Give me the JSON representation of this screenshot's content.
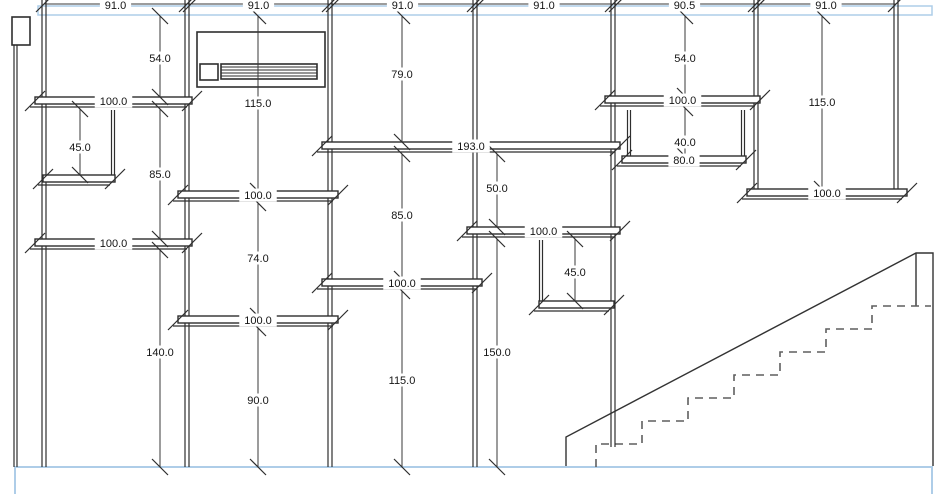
{
  "drawing": {
    "canvas": {
      "width": 950,
      "height": 494,
      "background": "#ffffff"
    },
    "colors": {
      "line": "#2e2e2e",
      "dimension": "#3a3a3a",
      "plate_highlight": "#aecde8",
      "stair_dash": "#5f5f5f",
      "text": "#141414"
    },
    "plates": {
      "top_band": {
        "x": 38,
        "y": 6,
        "w": 894,
        "h": 9
      },
      "bottom_band": {
        "x1": 15,
        "x2": 932,
        "y": 467,
        "bottom": 494
      }
    },
    "corner_box": {
      "x": 12,
      "y": 17,
      "w": 18,
      "h": 28
    },
    "top_dimension_line": {
      "y": 4,
      "x_start": 44,
      "x_end": 896,
      "ticks": [
        44,
        187,
        330,
        475,
        613,
        756,
        896
      ],
      "segments": [
        {
          "x1": 44,
          "x2": 187,
          "label": "91.0"
        },
        {
          "x1": 187,
          "x2": 330,
          "label": "91.0"
        },
        {
          "x1": 330,
          "x2": 475,
          "label": "91.0"
        },
        {
          "x1": 475,
          "x2": 613,
          "label": "91.0"
        },
        {
          "x1": 613,
          "x2": 756,
          "label": "90.5"
        },
        {
          "x1": 756,
          "x2": 896,
          "label": "91.0"
        }
      ]
    },
    "studs": [
      {
        "x": 15.5,
        "y1": 45,
        "y2": 467,
        "gap": 3
      },
      {
        "x": 44,
        "y1": 0,
        "y2": 467,
        "gap": 4
      },
      {
        "x": 187,
        "y1": 0,
        "y2": 467,
        "gap": 4
      },
      {
        "x": 330,
        "y1": 0,
        "y2": 467,
        "gap": 4
      },
      {
        "x": 475,
        "y1": 0,
        "y2": 467,
        "gap": 4
      },
      {
        "x": 613,
        "y1": 0,
        "y2": 447,
        "gap": 4
      },
      {
        "x": 756,
        "y1": 0,
        "y2": 192,
        "gap": 4
      },
      {
        "x": 896,
        "y1": 0,
        "y2": 190,
        "gap": 4
      },
      {
        "x": 113,
        "y1": 110,
        "y2": 176,
        "gap": 3
      },
      {
        "x": 541,
        "y1": 240,
        "y2": 302,
        "gap": 3
      },
      {
        "x": 629,
        "y1": 110,
        "y2": 157,
        "gap": 3
      },
      {
        "x": 743,
        "y1": 110,
        "y2": 157,
        "gap": 3
      }
    ],
    "sills": [
      {
        "x1": 35,
        "x2": 192,
        "y": 97,
        "label": "100.0"
      },
      {
        "x1": 35,
        "x2": 192,
        "y": 239,
        "label": "100.0"
      },
      {
        "x1": 178,
        "x2": 338,
        "y": 191,
        "label": "100.0"
      },
      {
        "x1": 178,
        "x2": 338,
        "y": 316,
        "label": "100.0"
      },
      {
        "x1": 322,
        "x2": 620,
        "y": 142,
        "label": "193.0"
      },
      {
        "x1": 322,
        "x2": 482,
        "y": 279,
        "label": "100.0"
      },
      {
        "x1": 467,
        "x2": 620,
        "y": 227,
        "label": "100.0"
      },
      {
        "x1": 605,
        "x2": 760,
        "y": 96,
        "label": "100.0"
      },
      {
        "x1": 622,
        "x2": 746,
        "y": 156,
        "label": "80.0"
      },
      {
        "x1": 747,
        "x2": 907,
        "y": 189,
        "label": "100.0"
      },
      {
        "x1": 43,
        "x2": 115,
        "y": 175,
        "label": ""
      },
      {
        "x1": 539,
        "x2": 614,
        "y": 301,
        "label": ""
      }
    ],
    "vertical_dimensions": [
      {
        "x": 160,
        "segments": [
          {
            "y1": 16,
            "y2": 97,
            "label": "54.0",
            "ly": 58
          },
          {
            "y1": 109,
            "y2": 239,
            "label": "85.0",
            "ly": 174
          },
          {
            "y1": 250,
            "y2": 467,
            "label": "140.0",
            "ly": 352
          }
        ]
      },
      {
        "x": 80,
        "segments": [
          {
            "y1": 109,
            "y2": 175,
            "label": "45.0",
            "ly": 147
          }
        ]
      },
      {
        "x": 258,
        "segments": [
          {
            "y1": 16,
            "y2": 191,
            "label": "115.0",
            "ly": 103
          },
          {
            "y1": 203,
            "y2": 316,
            "label": "74.0",
            "ly": 258
          },
          {
            "y1": 328,
            "y2": 467,
            "label": "90.0",
            "ly": 400
          }
        ]
      },
      {
        "x": 402,
        "segments": [
          {
            "y1": 16,
            "y2": 142,
            "label": "79.0",
            "ly": 74
          },
          {
            "y1": 154,
            "y2": 279,
            "label": "85.0",
            "ly": 215
          },
          {
            "y1": 291,
            "y2": 467,
            "label": "115.0",
            "ly": 380
          }
        ]
      },
      {
        "x": 497,
        "segments": [
          {
            "y1": 154,
            "y2": 227,
            "label": "50.0",
            "ly": 188
          },
          {
            "y1": 239,
            "y2": 467,
            "label": "150.0",
            "ly": 352
          }
        ]
      },
      {
        "x": 575,
        "segments": [
          {
            "y1": 239,
            "y2": 301,
            "label": "45.0",
            "ly": 272
          }
        ]
      },
      {
        "x": 685,
        "segments": [
          {
            "y1": 16,
            "y2": 96,
            "label": "54.0",
            "ly": 58
          },
          {
            "y1": 108,
            "y2": 156,
            "label": "40.0",
            "ly": 142
          }
        ]
      },
      {
        "x": 822,
        "segments": [
          {
            "y1": 16,
            "y2": 189,
            "label": "115.0",
            "ly": 102
          }
        ]
      }
    ],
    "vent_unit": {
      "outer": {
        "x": 197,
        "y": 32,
        "w": 128,
        "h": 55
      },
      "panel": {
        "x": 200,
        "y": 64,
        "w": 18,
        "h": 16
      },
      "grille": {
        "x": 221,
        "y": 64,
        "w": 96,
        "h": 15,
        "slat_lines": 4
      }
    },
    "stair": {
      "outline_path": "M 566 466 L 566 437 L 916 253 L 933 253 L 933 466",
      "post_line": {
        "x": 916,
        "y1": 253,
        "y2": 306
      },
      "steps_path": "M 596 467 L 596 444 L 642 444 L 642 421 L 688 421 L 688 398 L 734 398 L 734 375 L 780 375 L 780 352 L 826 352 L 826 329 L 872 329 L 872 306 L 931 306"
    }
  }
}
